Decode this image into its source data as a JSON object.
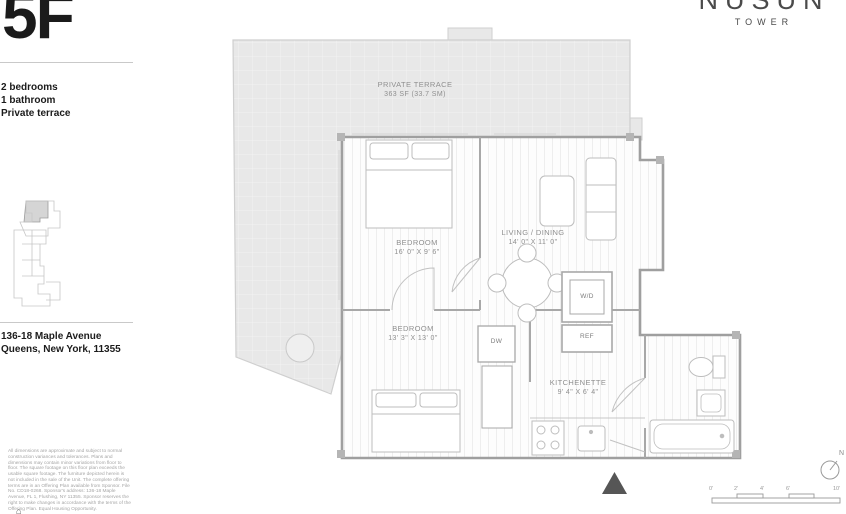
{
  "unit": {
    "name": "5F"
  },
  "brand": {
    "name": "NUSUN",
    "sub": "TOWER"
  },
  "summary": {
    "line1": "2 bedrooms",
    "line2": "1 bathroom",
    "line3": "Private terrace"
  },
  "address": {
    "line1": "136-18 Maple Avenue",
    "line2": "Queens, New York, 11355"
  },
  "plan": {
    "terrace": {
      "name": "PRIVATE TERRACE",
      "area": "363 SF (33.7 SM)"
    },
    "rooms": [
      {
        "name": "BEDROOM",
        "dims": "16' 0\" X 9' 6\""
      },
      {
        "name": "LIVING / DINING",
        "dims": "14' 0\" X 11' 0\""
      },
      {
        "name": "BEDROOM",
        "dims": "13' 3\" X 13' 0\""
      },
      {
        "name": "KITCHENETTE",
        "dims": "9' 4\" X 6' 4\""
      }
    ],
    "appliances": {
      "wd": "W/D",
      "ref": "REF",
      "dw": "DW"
    }
  },
  "compass": {
    "label": "N"
  },
  "scale_bar": {
    "ticks": [
      "0'",
      "2'",
      "4'",
      "6'",
      "10'"
    ]
  },
  "disclaimer": {
    "text": "All dimensions are approximate and subject to normal construction variances and tolerances. Plans and dimensions may contain minor variations from floor to floor. The square footage on this floor plan exceeds the usable square footage. The furniture depicted herein is not included in the sale of the Unit. The complete offering terms are in an Offering Plan available from Sponsor. File No. CD18-0268. Sponsor's address: 136-18 Maple Avenue, FL 1, Flushing, NY 11355. Sponsor reserves the right to make changes in accordance with the terms of the Offering Plan. Equal Housing Opportunity."
  },
  "eho": {
    "glyph": "⌂"
  },
  "colors": {
    "terrace_fill": "#e8e8e8",
    "wall": "#9f9f9f",
    "furniture": "#bdbdbd",
    "label": "#8f8f8f",
    "heading": "#1b1b1b"
  }
}
